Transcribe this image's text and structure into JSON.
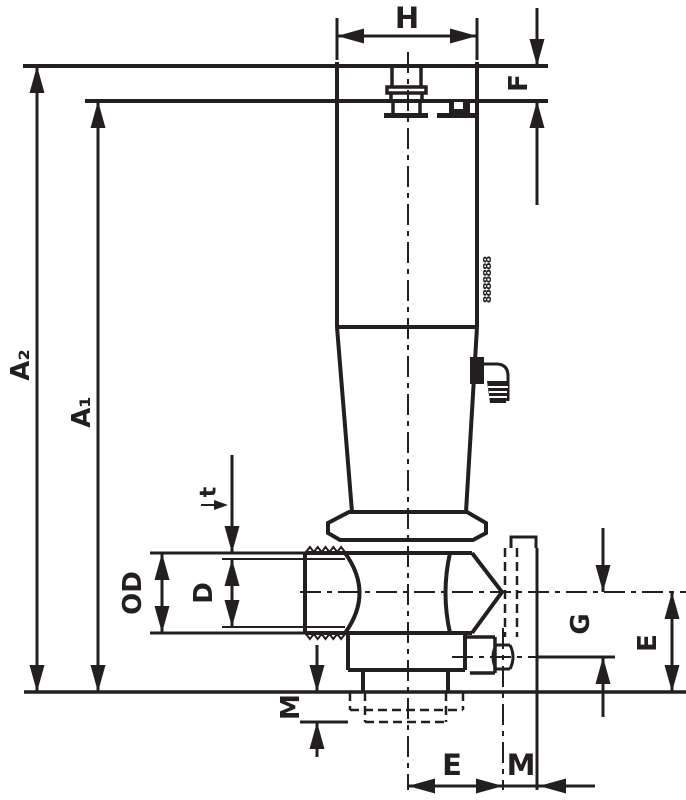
{
  "drawing": {
    "ink_color": "#231f20",
    "background_color": "#ffffff",
    "labels": {
      "h": "H",
      "f": "F",
      "a2": "A₂",
      "a1": "A₁",
      "t": "t",
      "od": "OD",
      "d": "D",
      "m_side": "M",
      "g": "G",
      "e_side": "E",
      "e_bottom": "E",
      "m_bottom": "M"
    },
    "marking_text": "8888888"
  }
}
